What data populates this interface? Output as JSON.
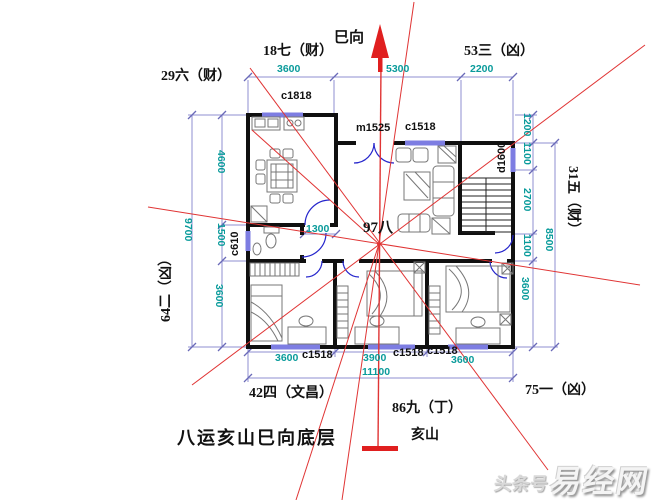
{
  "title": {
    "caption": "八运亥山巳向底层"
  },
  "compass": {
    "facing_label": "巳向",
    "sitting_label": "亥山",
    "center_star": "97八",
    "sectors": {
      "top": "18七（财）",
      "top_left": "29六（财）",
      "top_right": "53三（凶）",
      "left": "64二（凶）",
      "right": "31五（财）",
      "bottom_left": "42四（文昌）",
      "bottom": "86九（丁）",
      "bottom_right": "75一（凶）"
    }
  },
  "dims": {
    "top": [
      "3600",
      "5300",
      "2200"
    ],
    "bottom": [
      "3600",
      "3900",
      "3600"
    ],
    "bottom_total": "11100",
    "left": [
      "4600",
      "1500",
      "3600"
    ],
    "left_total": "9700",
    "right": [
      "1200",
      "1100",
      "2700",
      "1100",
      "3600"
    ],
    "right_total": "8500",
    "hall": "1300"
  },
  "openings": {
    "kitchen_window": "c1818",
    "entry_door": "m1525",
    "living_window": "c1518",
    "stair_window": "d1600",
    "bath_window": "c610",
    "bedroom1_window": "c1518",
    "bedroom2_window": "c1518",
    "bedroom3_window": "c1518"
  },
  "watermark": {
    "prefix": "头条号",
    "brand": "易经网"
  },
  "colors": {
    "wall": "#101010",
    "dim_line": "#8f8fd0",
    "dim_text": "#0a9b9b",
    "window": "#7d7de2",
    "door_arc": "#2626cc",
    "sector_line": "#e03434"
  }
}
